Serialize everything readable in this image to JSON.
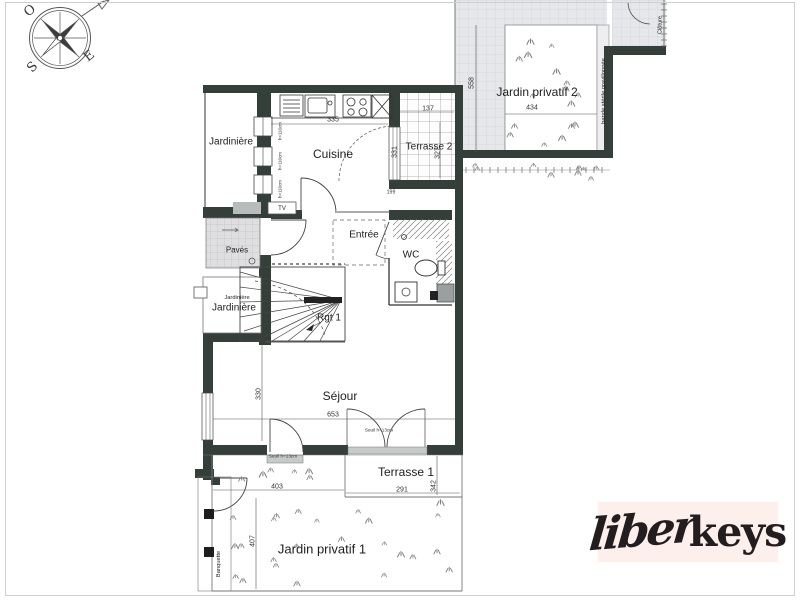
{
  "compass": {
    "west": "O",
    "east": "E",
    "south": "S"
  },
  "rooms": {
    "jardiniere_top": "Jardinière",
    "cuisine": "Cuisine",
    "terrasse2": "Terrasse 2",
    "entree": "Entrée",
    "wc": "WC",
    "paves": "Pavés",
    "jardiniere_mid_small": "Jardinière",
    "jardiniere_mid": "Jardinière",
    "storage": "Rgt 1",
    "tv": "TV",
    "sejour": "Séjour",
    "terrasse1": "Terrasse 1"
  },
  "outdoor": {
    "jardin2": "Jardin privatif 2",
    "jardin1": "Jardin privatif 1",
    "bande_sterile": "bande stérile gravillonnée",
    "cloture": "Clôture",
    "banquette": "Banquette"
  },
  "dimensions": {
    "cuisine_w": "335",
    "cuisine_h": "331",
    "terrasse2_w": "137",
    "terrasse2_h": "327",
    "jardin2_h": "558",
    "jardin2_w": "434",
    "sejour_w": "653",
    "sejour_h": "330",
    "jardin1_w": "403",
    "jardin1_h": "407",
    "terrasse1_w": "291",
    "terrasse1_h": "342",
    "door_w": "199"
  },
  "annotations": {
    "seuil_terrasse": "Seuil h=13cm",
    "seuil_jardin": "Seuil h=13cm",
    "window1": "h=110cm",
    "window2": "h=110cm",
    "window3": "h=110cm"
  },
  "logo": {
    "script": "liber",
    "bold": "keys"
  },
  "colors": {
    "wall": "#353f3a",
    "accent_bg": "#fcefec",
    "ink": "#241d20"
  }
}
